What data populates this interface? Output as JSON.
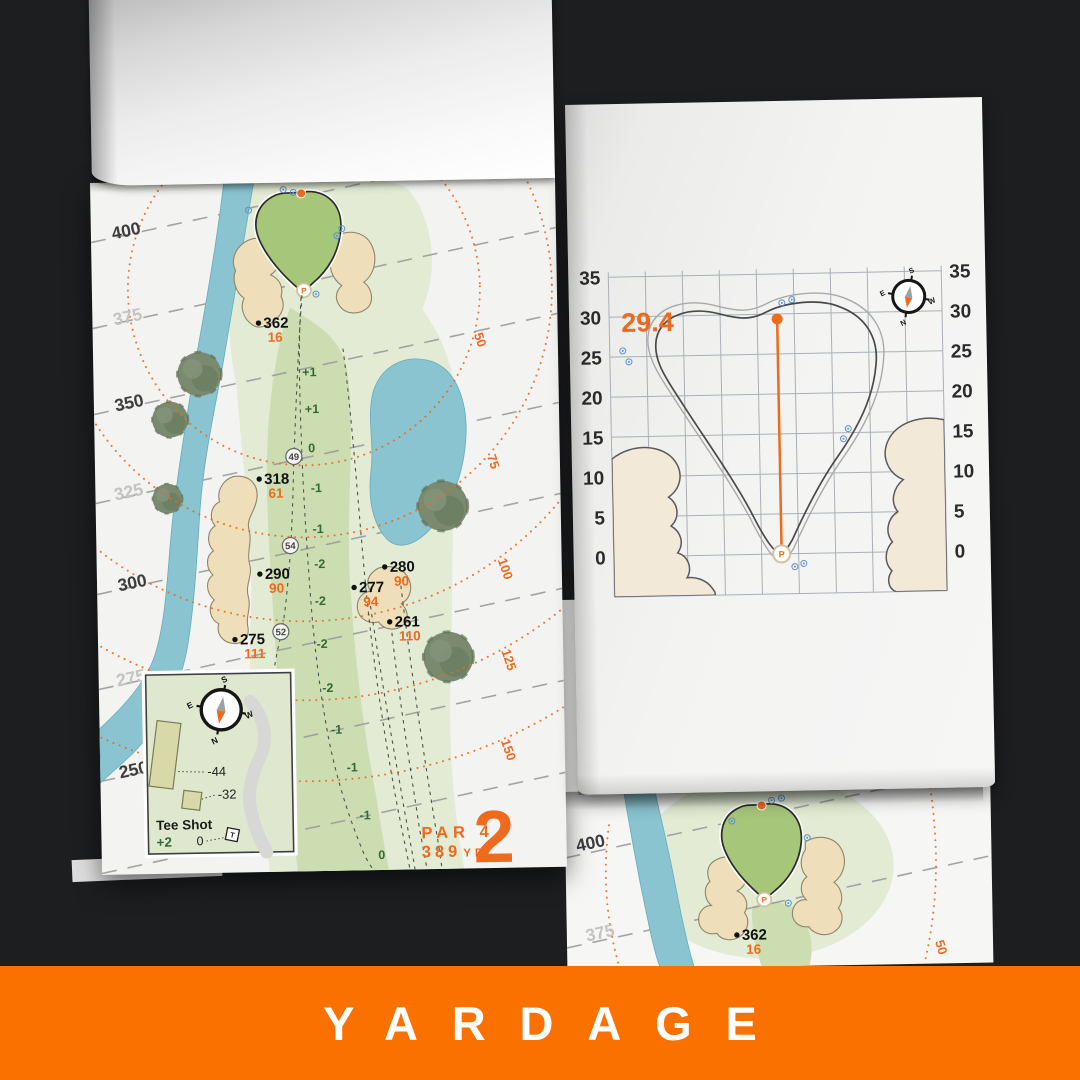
{
  "banner": {
    "label": "YARDAGE"
  },
  "colors": {
    "background": "#1d1e20",
    "banner_orange": "#fb7100",
    "accent_orange": "#ed6a1e",
    "water_blue": "#8ac4d0",
    "sand_tan": "#eedeb9",
    "fairway_green": "#cdddb2",
    "rough_green": "#e3ebd4",
    "putting_green": "#a6c679",
    "dark_green_text": "#2f6b33",
    "sprinkler_blue": "#5b93cc"
  },
  "left_page": {
    "hole": {
      "par": "PAR 4",
      "yardage": "389",
      "yardage_unit": "YD",
      "number": "2"
    },
    "distance_labels": [
      "400",
      "375",
      "350",
      "325",
      "300",
      "275",
      "250"
    ],
    "arc_labels": [
      "50",
      "75",
      "100",
      "125",
      "150"
    ],
    "markers": [
      {
        "carry": "362",
        "front": "16"
      },
      {
        "carry": "318",
        "front": "61"
      },
      {
        "carry": "290",
        "front": "90"
      },
      {
        "carry": "275",
        "front": "111"
      },
      {
        "carry": "280",
        "front": "90"
      },
      {
        "carry": "277",
        "front": "94"
      },
      {
        "carry": "261",
        "front": "110"
      }
    ],
    "centerline": [
      "+1",
      "+1",
      "0",
      "-1",
      "-1",
      "-2",
      "-2",
      "-2",
      "-2",
      "-1",
      "-1",
      "-1",
      "0"
    ],
    "circled": [
      "49",
      "54",
      "52"
    ],
    "inset": {
      "title": "Tee Shot",
      "handicap": "+2",
      "zero": "0",
      "offset_back": "-44",
      "offset_front": "-32",
      "tee_marker": "T"
    }
  },
  "right_page": {
    "pin_depth": "29.4",
    "axis": [
      "35",
      "30",
      "25",
      "20",
      "15",
      "10",
      "5",
      "0"
    ]
  },
  "under_page": {
    "label_400": "400",
    "label_375": "375",
    "arc_label": "50",
    "marker": {
      "carry": "362",
      "front": "16"
    }
  },
  "compass": {
    "n": "N",
    "s": "S",
    "e": "E",
    "w": "W"
  }
}
